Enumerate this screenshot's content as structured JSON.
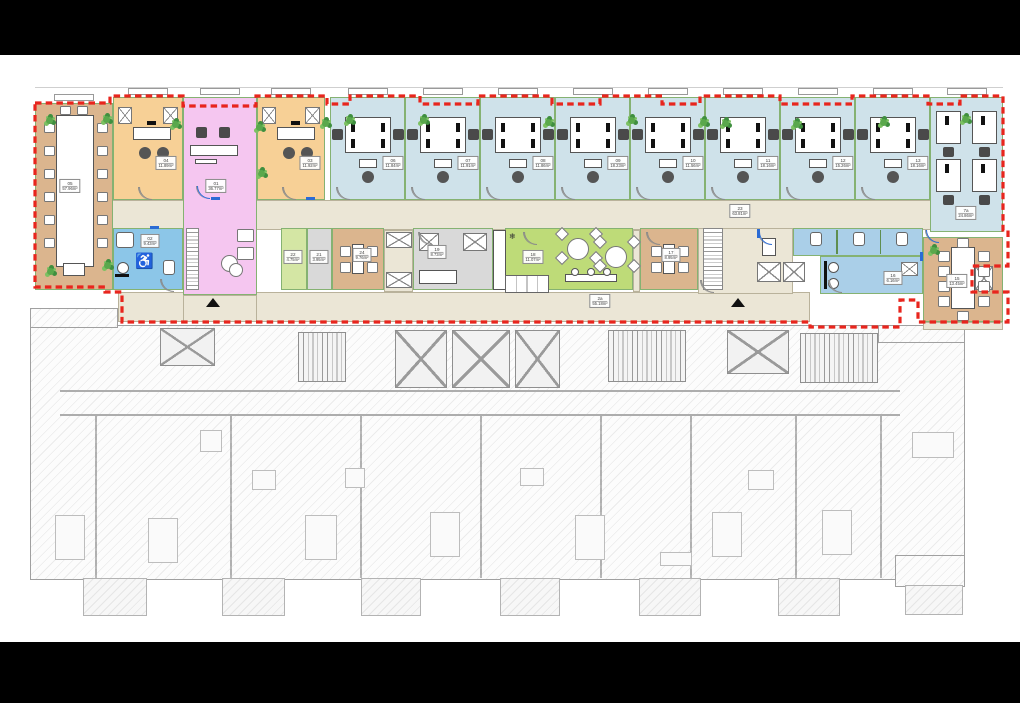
{
  "scene": {
    "background": "#000000",
    "sheet_background": "#ffffff"
  },
  "palette": {
    "tan": "#dbb58e",
    "orange": "#f7d096",
    "pink": "#f5c6f0",
    "blue": "#cfe2ea",
    "wcblue": "#8cc6e8",
    "wcblue2": "#aacfe8",
    "green": "#bedb78",
    "green_light": "#d4e6a4",
    "graycell": "#d9d9d9",
    "beige": "#ebe6d6",
    "wall_green": "#85b272",
    "boundary_red": "#e8251d",
    "plant_green": "#3f8f3f"
  },
  "floor_upper": {
    "boundary_color": "#e8251d",
    "corridor": {
      "label_num": "23",
      "label_area": "63.81m²",
      "label_at": [
        740,
        211
      ]
    },
    "lower_corridor": {
      "label_num": "2a",
      "label_area": "55.18m²",
      "label_at": [
        600,
        301
      ]
    },
    "corridor_rects": [
      [
        110,
        200,
        893,
        30
      ],
      [
        118,
        292,
        692,
        30
      ],
      [
        384,
        230,
        29,
        62
      ],
      [
        633,
        230,
        7,
        62
      ],
      [
        698,
        228,
        95,
        66
      ],
      [
        183,
        295,
        74,
        27
      ],
      [
        923,
        322,
        80,
        8
      ]
    ],
    "rooms": [
      {
        "id": "05",
        "num": "05",
        "area": "57.96m²",
        "type": "conference",
        "color": "tan",
        "rect": [
          35,
          103,
          78,
          187
        ],
        "label_at": [
          70,
          186
        ],
        "window": true
      },
      {
        "id": "04",
        "num": "04",
        "area": "11.89m²",
        "type": "office-single",
        "color": "orange",
        "rect": [
          113,
          97,
          70,
          103
        ],
        "label_at": [
          166,
          163
        ],
        "window": true
      },
      {
        "id": "01",
        "num": "01",
        "area": "36.77m²",
        "type": "reception",
        "color": "pink",
        "rect": [
          183,
          97,
          74,
          198
        ],
        "label_at": [
          216,
          186
        ],
        "window": true
      },
      {
        "id": "03",
        "num": "03",
        "area": "11.92m²",
        "type": "office-single",
        "color": "orange",
        "rect": [
          257,
          97,
          68,
          103
        ],
        "label_at": [
          310,
          163
        ],
        "window": true
      },
      {
        "id": "06",
        "num": "06",
        "area": "11.84m²",
        "type": "office-double",
        "color": "blue",
        "rect": [
          330,
          97,
          75,
          103
        ],
        "label_at": [
          393,
          163
        ],
        "window": true
      },
      {
        "id": "07",
        "num": "07",
        "area": "11.91m²",
        "type": "office-double",
        "color": "blue",
        "rect": [
          405,
          97,
          75,
          103
        ],
        "label_at": [
          468,
          163
        ],
        "window": true
      },
      {
        "id": "08",
        "num": "08",
        "area": "11.86m²",
        "type": "office-double",
        "color": "blue",
        "rect": [
          480,
          97,
          75,
          103
        ],
        "label_at": [
          543,
          163
        ],
        "window": true
      },
      {
        "id": "09",
        "num": "09",
        "area": "18.23m²",
        "type": "office-double",
        "color": "blue",
        "rect": [
          555,
          97,
          75,
          103
        ],
        "label_at": [
          618,
          163
        ],
        "window": true
      },
      {
        "id": "10",
        "num": "10",
        "area": "11.56m²",
        "type": "office-double",
        "color": "blue",
        "rect": [
          630,
          97,
          75,
          103
        ],
        "label_at": [
          693,
          163
        ],
        "window": true
      },
      {
        "id": "11",
        "num": "11",
        "area": "18.16m²",
        "type": "office-double",
        "color": "blue",
        "rect": [
          705,
          97,
          75,
          103
        ],
        "label_at": [
          768,
          163
        ],
        "window": true
      },
      {
        "id": "12",
        "num": "12",
        "area": "15.26m²",
        "type": "office-double",
        "color": "blue",
        "rect": [
          780,
          97,
          75,
          103
        ],
        "label_at": [
          843,
          163
        ],
        "window": true
      },
      {
        "id": "13",
        "num": "13",
        "area": "18.16m²",
        "type": "office-double",
        "color": "blue",
        "rect": [
          855,
          97,
          75,
          103
        ],
        "label_at": [
          918,
          163
        ],
        "window": true
      },
      {
        "id": "7a",
        "num": "7a",
        "area": "24.86m²",
        "type": "office-tall",
        "color": "blue",
        "rect": [
          930,
          97,
          73,
          135
        ],
        "label_at": [
          966,
          213
        ],
        "window": true
      },
      {
        "id": "02",
        "num": "02",
        "area": "9.43m²",
        "type": "wc-accessible",
        "color": "wcblue",
        "rect": [
          113,
          228,
          70,
          62
        ],
        "label_at": [
          150,
          241
        ]
      },
      {
        "id": "22",
        "num": "22",
        "area": "4.75m²",
        "type": "small",
        "color": "green_light",
        "rect": [
          281,
          228,
          26,
          62
        ],
        "label_at": [
          293,
          257
        ]
      },
      {
        "id": "21",
        "num": "21",
        "area": "3.95m²",
        "type": "small",
        "color": "graycell",
        "rect": [
          307,
          228,
          25,
          62
        ],
        "label_at": [
          319,
          257
        ]
      },
      {
        "id": "24",
        "num": "24",
        "area": "9.76m²",
        "type": "meeting",
        "color": "tan",
        "rect": [
          332,
          228,
          52,
          62
        ],
        "label_at": [
          362,
          255
        ]
      },
      {
        "id": "19",
        "num": "19",
        "area": "8.73m²",
        "type": "storage",
        "color": "graycell",
        "rect": [
          413,
          228,
          80,
          62
        ],
        "label_at": [
          437,
          252
        ]
      },
      {
        "id": "18",
        "num": "18",
        "area": "11.07m²",
        "type": "break",
        "color": "green",
        "rect": [
          505,
          228,
          128,
          62
        ],
        "label_at": [
          533,
          257
        ]
      },
      {
        "id": "17",
        "num": "17",
        "area": "8.95m²",
        "type": "meeting",
        "color": "tan",
        "rect": [
          640,
          228,
          58,
          62
        ],
        "label_at": [
          671,
          255
        ]
      },
      {
        "id": "16s",
        "num": "",
        "area": "",
        "type": "wc-stalls",
        "color": "wcblue2",
        "rect": [
          793,
          228,
          130,
          28
        ],
        "label_at": null
      },
      {
        "id": "16",
        "num": "16",
        "area": "6.16m²",
        "type": "washroom",
        "color": "wcblue2",
        "rect": [
          820,
          256,
          103,
          38
        ],
        "label_at": [
          893,
          278
        ]
      },
      {
        "id": "15",
        "num": "15",
        "area": "13.45m²",
        "type": "meeting-large",
        "color": "tan",
        "rect": [
          923,
          237,
          80,
          85
        ],
        "label_at": [
          957,
          281
        ]
      }
    ],
    "extras": {
      "stair_strips": [
        [
          703,
          228,
          20,
          62
        ],
        [
          186,
          228,
          13,
          62
        ]
      ],
      "elevator_boxes": [
        [
          757,
          262,
          24,
          20
        ],
        [
          783,
          262,
          22,
          20
        ],
        [
          386,
          232,
          26,
          16
        ],
        [
          386,
          272,
          26,
          16
        ],
        [
          975,
          266,
          18,
          24
        ]
      ],
      "kitchen_column": [
        493,
        230,
        13,
        60
      ],
      "kitchen_counter": [
        505,
        275,
        44,
        18
      ],
      "lobby_desk": [
        762,
        238,
        14,
        18
      ]
    },
    "plants": [
      [
        46,
        117
      ],
      [
        103,
        116
      ],
      [
        172,
        121
      ],
      [
        256,
        124
      ],
      [
        322,
        120
      ],
      [
        346,
        117
      ],
      [
        420,
        117
      ],
      [
        545,
        119
      ],
      [
        628,
        117
      ],
      [
        700,
        119
      ],
      [
        722,
        120
      ],
      [
        793,
        121
      ],
      [
        880,
        119
      ],
      [
        962,
        116
      ],
      [
        47,
        268
      ],
      [
        104,
        262
      ],
      [
        258,
        170
      ],
      [
        930,
        247
      ]
    ],
    "entrance_triangles": [
      [
        206,
        298
      ],
      [
        731,
        298
      ]
    ],
    "door_accents": [
      [
        211,
        197,
        9,
        3
      ],
      [
        306,
        197,
        9,
        3
      ],
      [
        150,
        226,
        9,
        3
      ],
      [
        757,
        229,
        3,
        9
      ],
      [
        920,
        252,
        3,
        9
      ]
    ],
    "door_arcs": [
      [
        138,
        187
      ],
      [
        282,
        187
      ],
      [
        336,
        187
      ],
      [
        411,
        187
      ],
      [
        486,
        187
      ],
      [
        561,
        187
      ],
      [
        636,
        187
      ],
      [
        711,
        187
      ],
      [
        786,
        187
      ],
      [
        861,
        187
      ],
      [
        418,
        232
      ],
      [
        523,
        232
      ],
      [
        646,
        232
      ],
      [
        700,
        280
      ],
      [
        828,
        280
      ],
      [
        160,
        279
      ]
    ],
    "blue_arcs": [
      [
        196,
        186
      ],
      [
        925,
        230
      ],
      [
        758,
        232
      ]
    ]
  },
  "floor_lower": {
    "body": [
      30,
      325,
      935,
      255
    ],
    "top_steps": [
      [
        30,
        308,
        88,
        20
      ],
      [
        878,
        325,
        87,
        18
      ]
    ],
    "right_wing": [
      895,
      555,
      70,
      32
    ],
    "cores": [
      {
        "kind": "x",
        "rect": [
          160,
          328,
          55,
          38
        ]
      },
      {
        "kind": "stair",
        "rect": [
          298,
          332,
          48,
          50
        ]
      },
      {
        "kind": "x",
        "rect": [
          395,
          330,
          52,
          58
        ]
      },
      {
        "kind": "x",
        "rect": [
          452,
          330,
          58,
          58
        ]
      },
      {
        "kind": "x",
        "rect": [
          515,
          330,
          45,
          58
        ]
      },
      {
        "kind": "stair",
        "rect": [
          608,
          330,
          78,
          52
        ]
      },
      {
        "kind": "x",
        "rect": [
          727,
          330,
          62,
          44
        ]
      },
      {
        "kind": "stair",
        "rect": [
          800,
          333,
          78,
          50
        ]
      }
    ],
    "corridor_lines": [
      [
        60,
        390,
        840
      ],
      [
        60,
        414,
        840
      ]
    ],
    "dividers_x": [
      95,
      230,
      360,
      480,
      600,
      690,
      795,
      880
    ],
    "dividers_y": [
      416,
      578
    ],
    "furniture": [
      [
        55,
        515,
        30,
        45
      ],
      [
        148,
        518,
        30,
        45
      ],
      [
        252,
        470,
        24,
        20
      ],
      [
        305,
        515,
        32,
        45
      ],
      [
        430,
        512,
        30,
        45
      ],
      [
        520,
        468,
        24,
        18
      ],
      [
        575,
        515,
        30,
        45
      ],
      [
        660,
        552,
        32,
        14
      ],
      [
        712,
        512,
        30,
        45
      ],
      [
        822,
        510,
        30,
        45
      ],
      [
        912,
        432,
        42,
        26
      ],
      [
        200,
        430,
        22,
        22
      ],
      [
        345,
        468,
        20,
        20
      ],
      [
        748,
        470,
        26,
        20
      ]
    ],
    "balconies": [
      [
        83,
        578,
        64,
        38
      ],
      [
        222,
        578,
        63,
        38
      ],
      [
        361,
        578,
        60,
        38
      ],
      [
        500,
        578,
        60,
        38
      ],
      [
        639,
        578,
        62,
        38
      ],
      [
        778,
        578,
        62,
        38
      ],
      [
        905,
        585,
        58,
        30
      ]
    ]
  },
  "letterbox": {
    "top_height": 55,
    "bottom_top": 642
  }
}
